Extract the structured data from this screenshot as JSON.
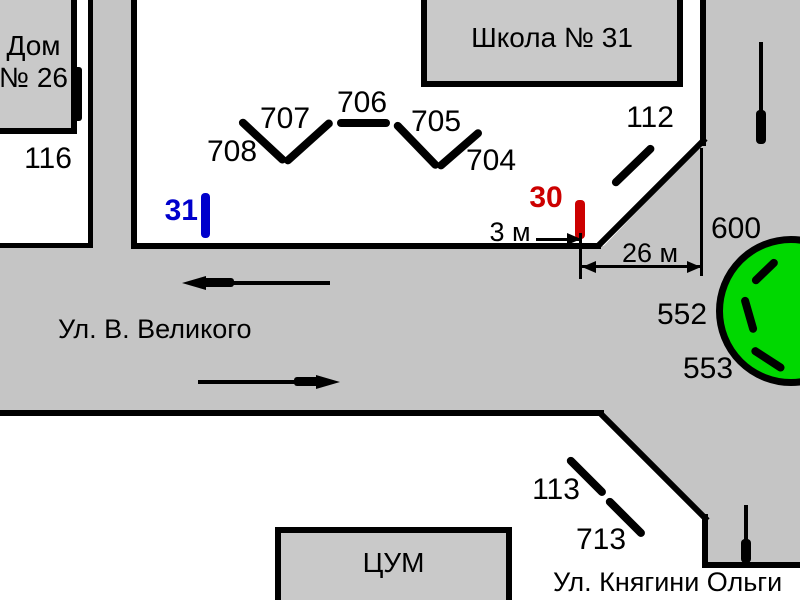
{
  "colors": {
    "street": "#c5c5c5",
    "block_fill": "#ffffff",
    "building_fill": "#c9c9c9",
    "outline": "#000000",
    "green_area": "#00d800",
    "point_blue": "#0000cc",
    "point_red": "#cc0000"
  },
  "buildings": {
    "house": {
      "line1": "Дом",
      "line2": "№ 26"
    },
    "school": {
      "name": "Школа № 31"
    },
    "tsum": {
      "name": "ЦУМ"
    }
  },
  "streets": {
    "main": {
      "name": "Ул. В. Великого"
    },
    "cross": {
      "name": "Ул. Княгини Ольги"
    }
  },
  "marks": {
    "m116": "116",
    "m708": "708",
    "m707": "707",
    "m706": "706",
    "m705": "705",
    "m704": "704",
    "m112": "112",
    "m113": "113",
    "m713": "713",
    "m600": "600",
    "m552": "552",
    "m553": "553"
  },
  "points": {
    "blue": {
      "label": "31",
      "color": "#0000cc"
    },
    "red": {
      "label": "30",
      "color": "#cc0000"
    }
  },
  "dimensions": {
    "gap": "3 м",
    "width": "26 м"
  }
}
